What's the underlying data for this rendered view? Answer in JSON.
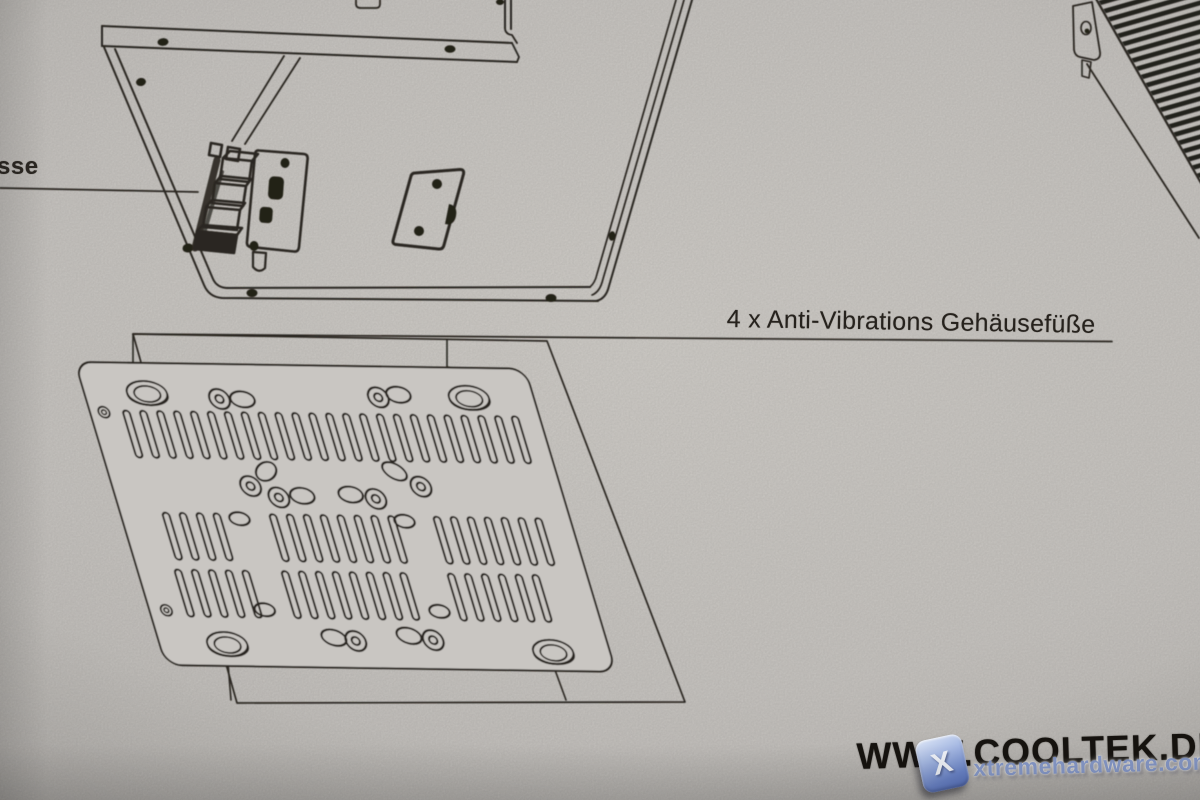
{
  "page": {
    "width": 1200,
    "height": 800
  },
  "colors": {
    "paper": "#c9c6c2",
    "ink": "#2a2620",
    "watermark_blue": "#7d92c8",
    "footer_text": "#16130f"
  },
  "labels": {
    "connectors_partial": "sse",
    "feet": "4 x Anti-Vibrations Gehäusefüße"
  },
  "footer": {
    "website": "WWW.COOLTEK.DE"
  },
  "watermark": {
    "text": "xtremehardware.com",
    "icon_letter": "X"
  }
}
